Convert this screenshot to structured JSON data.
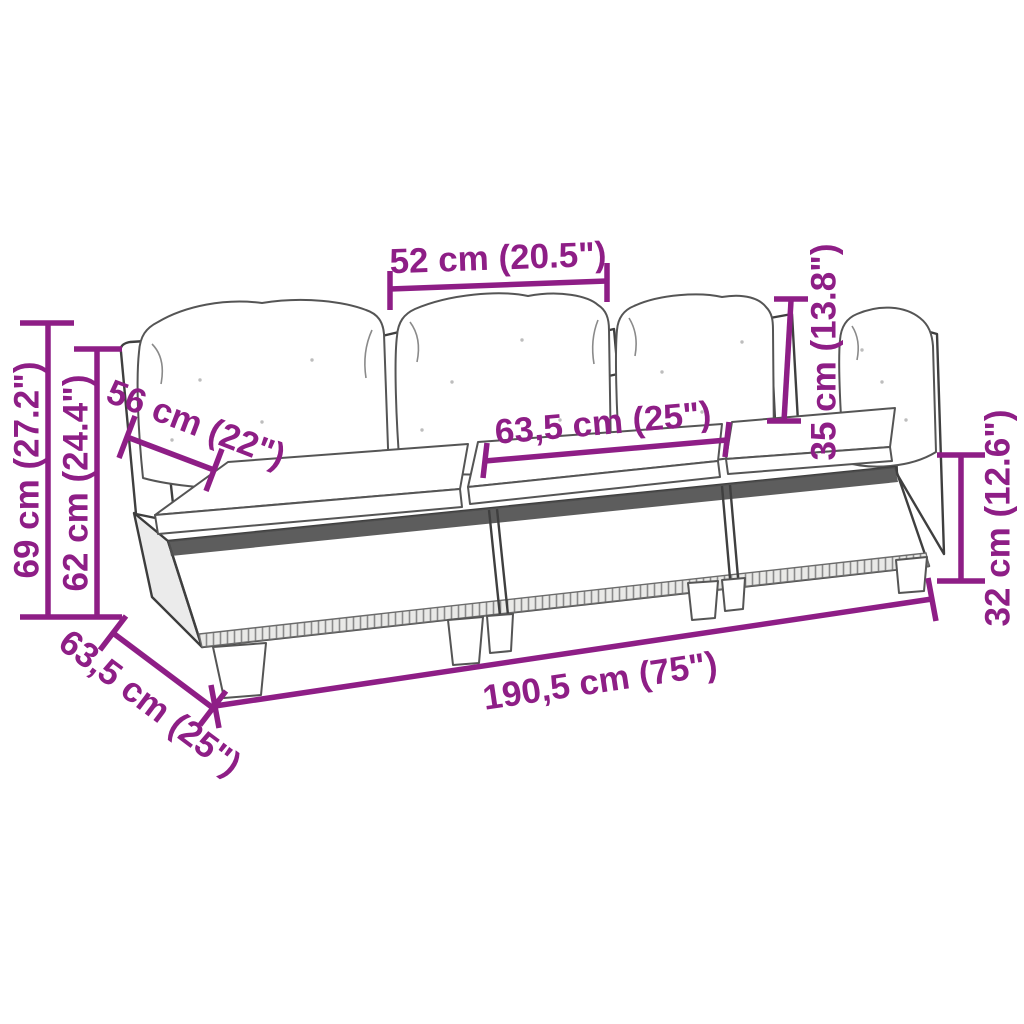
{
  "figure": {
    "type": "product-dimension-diagram",
    "subject": "3-piece poly rattan garden sofa with cushions, line drawing",
    "background_color": "#ffffff",
    "accent_color": "#8E1E86",
    "line_color": "#3f3f3f"
  },
  "dimensions": {
    "back_section_width": "52 cm (20.5\")",
    "total_height": "69 cm (27.2\")",
    "frame_height": "62 cm (24.4\")",
    "back_depth": "56 cm (22\")",
    "seat_width": "63,5 cm (25\")",
    "backrest_height": "35 cm (13.8\")",
    "seat_height": "32 cm (12.6\")",
    "total_width": "190,5 cm (75\")",
    "total_depth": "63,5 cm (25\")"
  }
}
